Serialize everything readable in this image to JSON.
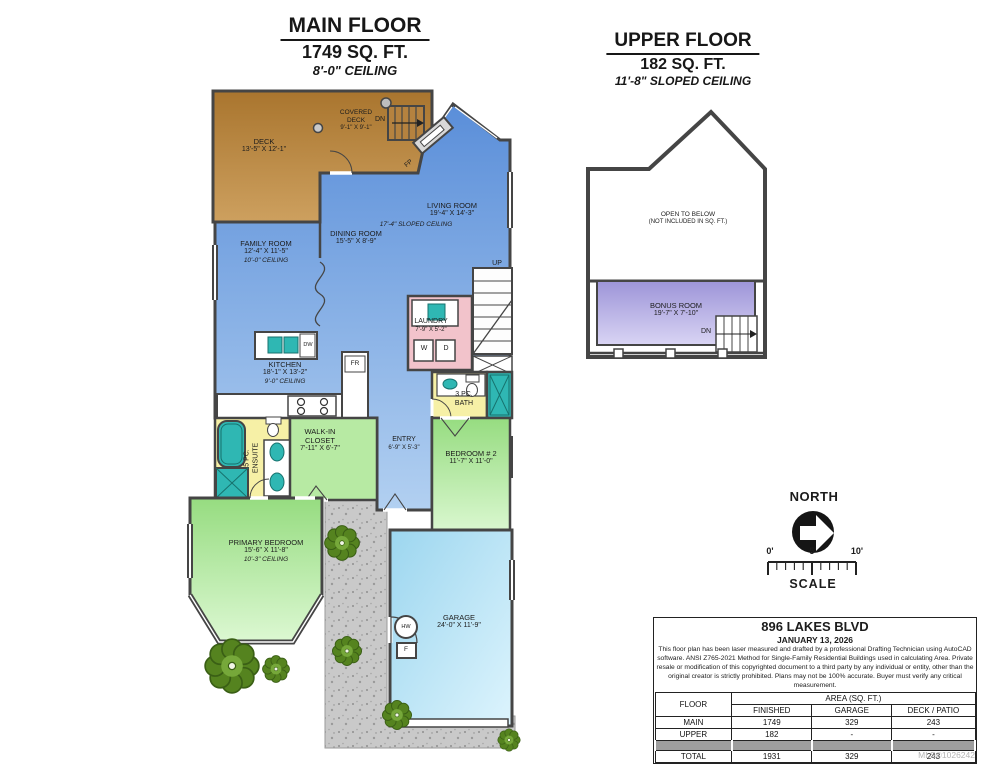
{
  "titles": {
    "main": {
      "name": "MAIN FLOOR",
      "area": "1749 SQ. FT.",
      "ceiling": "8'-0\" CEILING"
    },
    "upper": {
      "name": "UPPER FLOOR",
      "area": "182 SQ. FT.",
      "ceiling": "11'-8\" SLOPED CEILING"
    }
  },
  "rooms": {
    "deck": {
      "name": "DECK",
      "dims": "13'-5\" X 12'-1\""
    },
    "covered_deck": {
      "line1": "COVERED",
      "line2": "DECK",
      "dims": "9'-1\" X 9'-1\""
    },
    "living": {
      "name": "LIVING ROOM",
      "dims": "19'-4\" X 14'-3\"",
      "ceiling": "17'-4\"  SLOPED CEILING"
    },
    "dining": {
      "name": "DINING ROOM",
      "dims": "15'-5\" X 8'-9\""
    },
    "family": {
      "name": "FAMILY ROOM",
      "dims": "12'-4\" X 11'-5\"",
      "ceiling": "10'-0\" CEILING"
    },
    "kitchen": {
      "name": "KITCHEN",
      "dims": "18'-1\" X 13'-2\"",
      "ceiling": "9'-0\" CEILING"
    },
    "laundry": {
      "name": "LAUNDRY",
      "dims": "7'-9\" X 5'-2\""
    },
    "bath": {
      "line1": "3 PC.",
      "line2": "BATH"
    },
    "ensuite": {
      "line1": "5 PC.",
      "line2": "ENSUITE"
    },
    "closet": {
      "line1": "WALK-IN",
      "line2": "CLOSET",
      "dims": "7'-11\" X 6'-7\""
    },
    "entry": {
      "name": "ENTRY",
      "dims": "6'-9\" X 5'-3\""
    },
    "bedroom2": {
      "name": "BEDROOM # 2",
      "dims": "11'-7\" X 11'-0\""
    },
    "primary": {
      "name": "PRIMARY BEDROOM",
      "dims": "15'-6\" X 11'-8\"",
      "ceiling": "10'-3\" CEILING"
    },
    "garage": {
      "name": "GARAGE",
      "dims": "24'-0\" X 11'-9\""
    }
  },
  "ann": {
    "dn": "DN",
    "up": "UP",
    "fp": "FP",
    "w": "W",
    "d": "D",
    "dw": "DW",
    "fr": "FR",
    "hw": "HW",
    "f": "F"
  },
  "upper": {
    "open_line1": "OPEN TO BELOW",
    "open_line2": "(NOT INCLUDED IN SQ. FT.)",
    "bonus": {
      "name": "BONUS ROOM",
      "dims": "19'-7\" X 7'-10\""
    }
  },
  "compass": {
    "label": "NORTH"
  },
  "scalebar": {
    "t0": "0'",
    "t5": "5'",
    "t10": "10'",
    "label": "SCALE"
  },
  "info": {
    "address": "896 LAKES BLVD",
    "date": "JANUARY 13, 2026",
    "disclaimer": "This floor plan has been laser measured and drafted by a professional Drafting Technician using AutoCAD software. ANSI Z765-2021 Method for Single-Family Residential Buildings used in calculating Area. Private resale or modification of this copyrighted document to a third party by any individual or entity, other than the original creator is strictly prohibited. Plans may not be 100% accurate.  Buyer must verify any critical measurement.",
    "table": {
      "floor_header": "FLOOR",
      "area_header": "AREA (SQ. FT.)",
      "cols": [
        "FINISHED",
        "GARAGE",
        "DECK / PATIO"
      ],
      "rows": [
        [
          "MAIN",
          "1749",
          "329",
          "243"
        ],
        [
          "UPPER",
          "182",
          "-",
          "-"
        ],
        [
          "TOTAL",
          "1931",
          "329",
          "243"
        ]
      ]
    }
  },
  "mls": "MLS®1026242",
  "colors": {
    "wall": "#454545",
    "deck": "#b5823f",
    "living_blue": "#6d9ee0",
    "bedroom_green": "#a9e294",
    "garage_cyan": "#b5e3f5",
    "laundry_pink": "#f2c3cb",
    "bath_yellow": "#f6f0a6",
    "bonus_purple": "#aaa2dc",
    "fixture_teal": "#2fb7b3"
  }
}
